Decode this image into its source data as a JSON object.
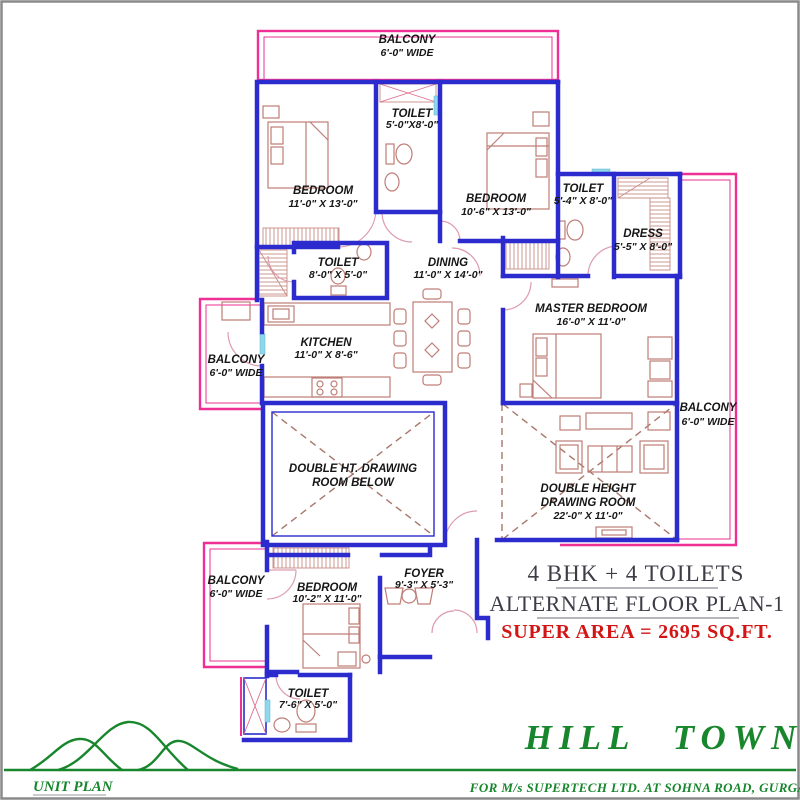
{
  "type": "floor-plan",
  "colors": {
    "wall_blue": "#2b2bce",
    "balcony_pink": "#ee2f93",
    "furniture_rose": "#bf7d76",
    "door_arc": "#dd9cae",
    "window_cyan": "#8fd8ec",
    "label_black": "#161616",
    "heading_gray": "#3d3d47",
    "super_area_red": "#d31515",
    "brand_green": "#17862c",
    "page_border_gray": "#8a8a8a"
  },
  "rooms": [
    {
      "id": "balcony-top",
      "lines": [
        "BALCONY",
        "6'-0\" WIDE"
      ]
    },
    {
      "id": "bedroom-1",
      "lines": [
        "BEDROOM",
        "11'-0\" X 13'-0\""
      ]
    },
    {
      "id": "toilet-top",
      "lines": [
        "TOILET",
        "5'-0\"X8'-0\""
      ]
    },
    {
      "id": "bedroom-2",
      "lines": [
        "BEDROOM",
        "10'-6\" X 13'-0\""
      ]
    },
    {
      "id": "toilet-right",
      "lines": [
        "TOILET",
        "5'-4\" X 8'-0\""
      ]
    },
    {
      "id": "dress",
      "lines": [
        "DRESS",
        "5'-5\" X 8'-0\""
      ]
    },
    {
      "id": "toilet-mid",
      "lines": [
        "TOILET",
        "8'-0\" X 5'-0\""
      ]
    },
    {
      "id": "dining",
      "lines": [
        "DINING",
        "11'-0\" X 14'-0\""
      ]
    },
    {
      "id": "kitchen",
      "lines": [
        "KITCHEN",
        "11'-0\" X 8'-6\""
      ]
    },
    {
      "id": "master-bedroom",
      "lines": [
        "MASTER BEDROOM",
        "16'-0\" X 11'-0\""
      ]
    },
    {
      "id": "balcony-left",
      "lines": [
        "BALCONY",
        "6'-0\" WIDE"
      ]
    },
    {
      "id": "balcony-right",
      "lines": [
        "BALCONY",
        "6'-0\" WIDE"
      ]
    },
    {
      "id": "drawing-room-below",
      "lines": [
        "DOUBLE HT. DRAWING",
        "ROOM BELOW"
      ]
    },
    {
      "id": "double-height-drawing-room",
      "lines": [
        "DOUBLE HEIGHT",
        "DRAWING ROOM",
        "22'-0\" X 11'-0\""
      ]
    },
    {
      "id": "balcony-bottom",
      "lines": [
        "BALCONY",
        "6'-0\" WIDE"
      ]
    },
    {
      "id": "bedroom-3",
      "lines": [
        "BEDROOM",
        "10'-2\" X 11'-0\""
      ]
    },
    {
      "id": "foyer",
      "lines": [
        "FOYER",
        "9'-3\" X 5'-3\""
      ]
    },
    {
      "id": "toilet-bottom",
      "lines": [
        "TOILET",
        "7'-6\" X 5'-0\""
      ]
    }
  ],
  "summary": {
    "bhk": "4 BHK + 4 TOILETS",
    "plan": "ALTERNATE FLOOR PLAN-1",
    "area": "SUPER AREA = 2695 SQ.FT."
  },
  "footer": {
    "project": "HILL TOWN",
    "client": "FOR M/s SUPERTECH LTD.  AT SOHNA ROAD,  GURGAON",
    "sheet": "UNIT PLAN"
  }
}
